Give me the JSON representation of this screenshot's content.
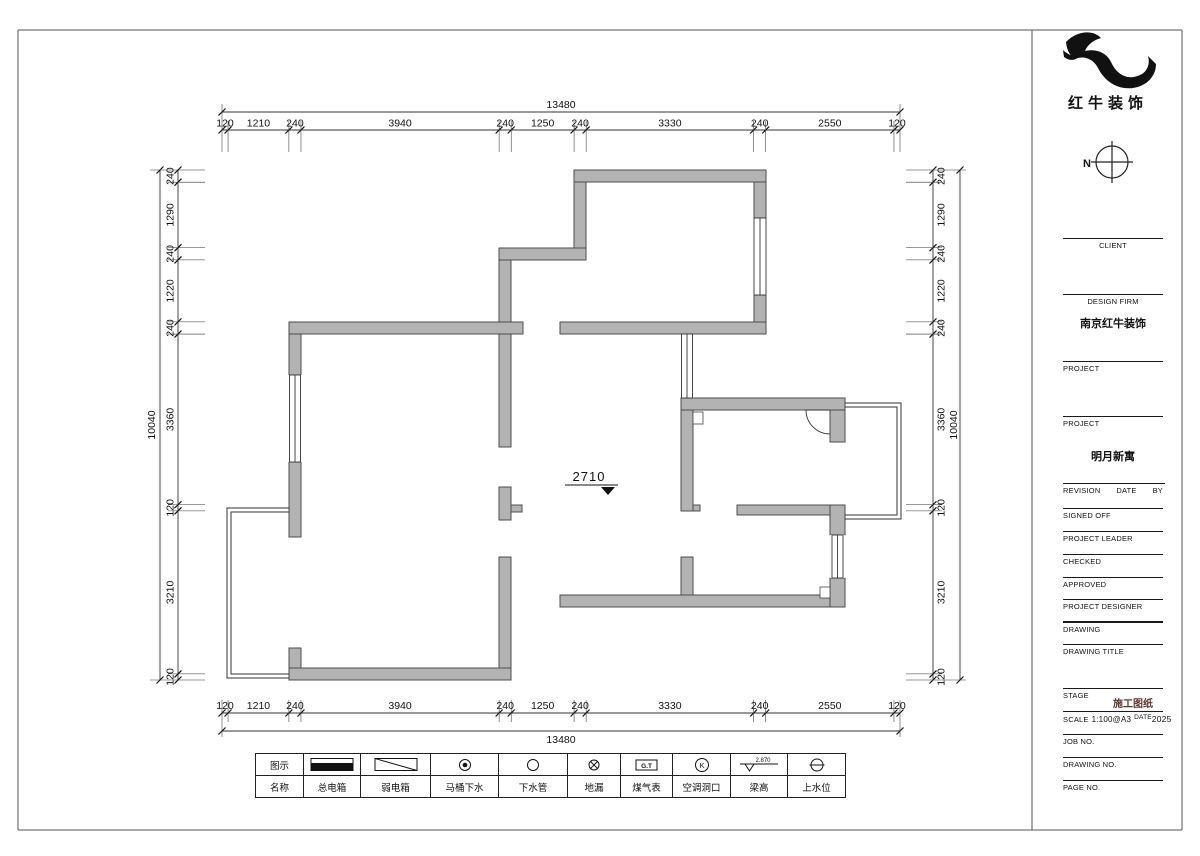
{
  "brand": {
    "name": "红牛装饰",
    "north_label": "N"
  },
  "titleblock": {
    "client_label": "CLIENT",
    "design_firm_label": "DESIGN FIRM",
    "design_firm_value": "南京红牛装饰",
    "project_label_1": "PROJECT",
    "project_label_2": "PROJECT",
    "project_value": "明月新寓",
    "revision_label": "REVISION",
    "date_label": "DATE",
    "by_label": "BY",
    "signed_off_label": "SIGNED OFF",
    "project_leader_label": "PROJECT LEADER",
    "checked_label": "CHECKED",
    "approved_label": "APPROVED",
    "project_designer_label": "PROJECT DESIGNER",
    "drawing_label": "DRAWING",
    "drawing_title_label": "DRAWING TITLE",
    "stage_label": "STAGE",
    "stage_value": "施工图纸",
    "scale_label": "SCALE",
    "scale_value": "1:100@A3",
    "scale_date_label": "DATE",
    "scale_date_value": "2025",
    "job_no_label": "JOB NO.",
    "drawing_no_label": "DRAWING NO.",
    "page_no_label": "PAGE NO."
  },
  "plan": {
    "ceiling_height": "2710",
    "dims": {
      "top_total": "13480",
      "bottom_total": "13480",
      "left_total": "10040",
      "right_total": "10040",
      "top": [
        120,
        1210,
        240,
        3940,
        240,
        1250,
        240,
        3330,
        240,
        2550,
        120
      ],
      "bottom": [
        120,
        1210,
        240,
        3940,
        240,
        1250,
        240,
        3330,
        240,
        2550,
        120
      ],
      "left": [
        240,
        1290,
        240,
        1220,
        240,
        3360,
        120,
        3210,
        120
      ],
      "right": [
        240,
        1290,
        240,
        1220,
        240,
        3360,
        120,
        3210,
        120
      ]
    }
  },
  "legend": {
    "row1_label": "图示",
    "row2_label": "名称",
    "items": [
      {
        "name": "总电箱",
        "icon": "main-electric-box-icon"
      },
      {
        "name": "弱电箱",
        "icon": "weak-electric-box-icon"
      },
      {
        "name": "马桶下水",
        "icon": "toilet-drain-icon"
      },
      {
        "name": "下水管",
        "icon": "drain-pipe-icon"
      },
      {
        "name": "地漏",
        "icon": "floor-drain-icon"
      },
      {
        "name": "煤气表",
        "icon": "gas-meter-icon",
        "icon_text": "G.T"
      },
      {
        "name": "空调洞口",
        "icon": "ac-hole-icon",
        "icon_text": "K"
      },
      {
        "name": "梁高",
        "icon": "beam-height-icon",
        "beam_value": "2.870"
      },
      {
        "name": "上水位",
        "icon": "water-supply-icon"
      }
    ]
  }
}
